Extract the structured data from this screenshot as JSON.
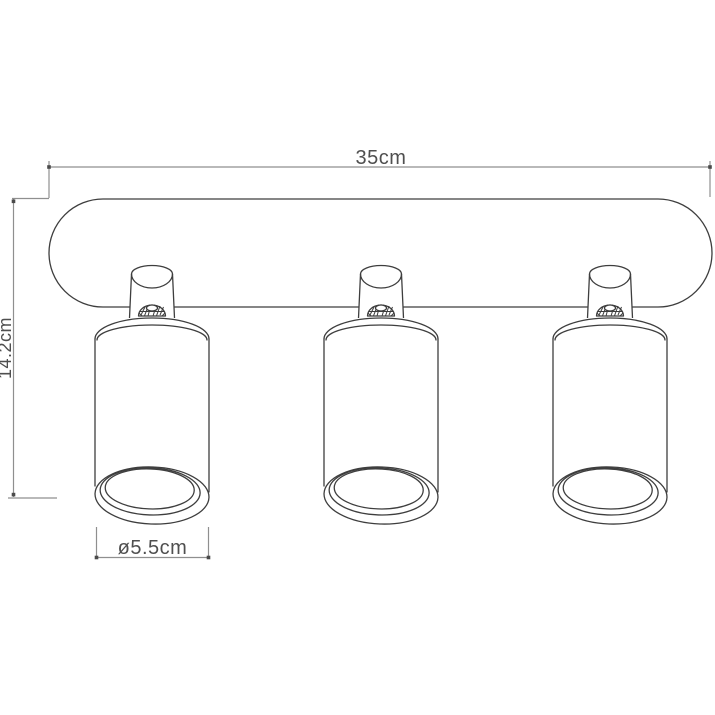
{
  "drawing": {
    "kind": "technical-dimension-drawing",
    "subject": "triple ceiling spotlight fixture",
    "spot_count": 3,
    "dimensions": {
      "width_label": "35cm",
      "height_label": "14.2cm",
      "diameter_label": "ø5.5cm"
    },
    "colors": {
      "background": "#ffffff",
      "outline": "#3e3e3e",
      "dimension_line": "#8f8f8f",
      "dimension_text": "#4f4f4f"
    }
  }
}
